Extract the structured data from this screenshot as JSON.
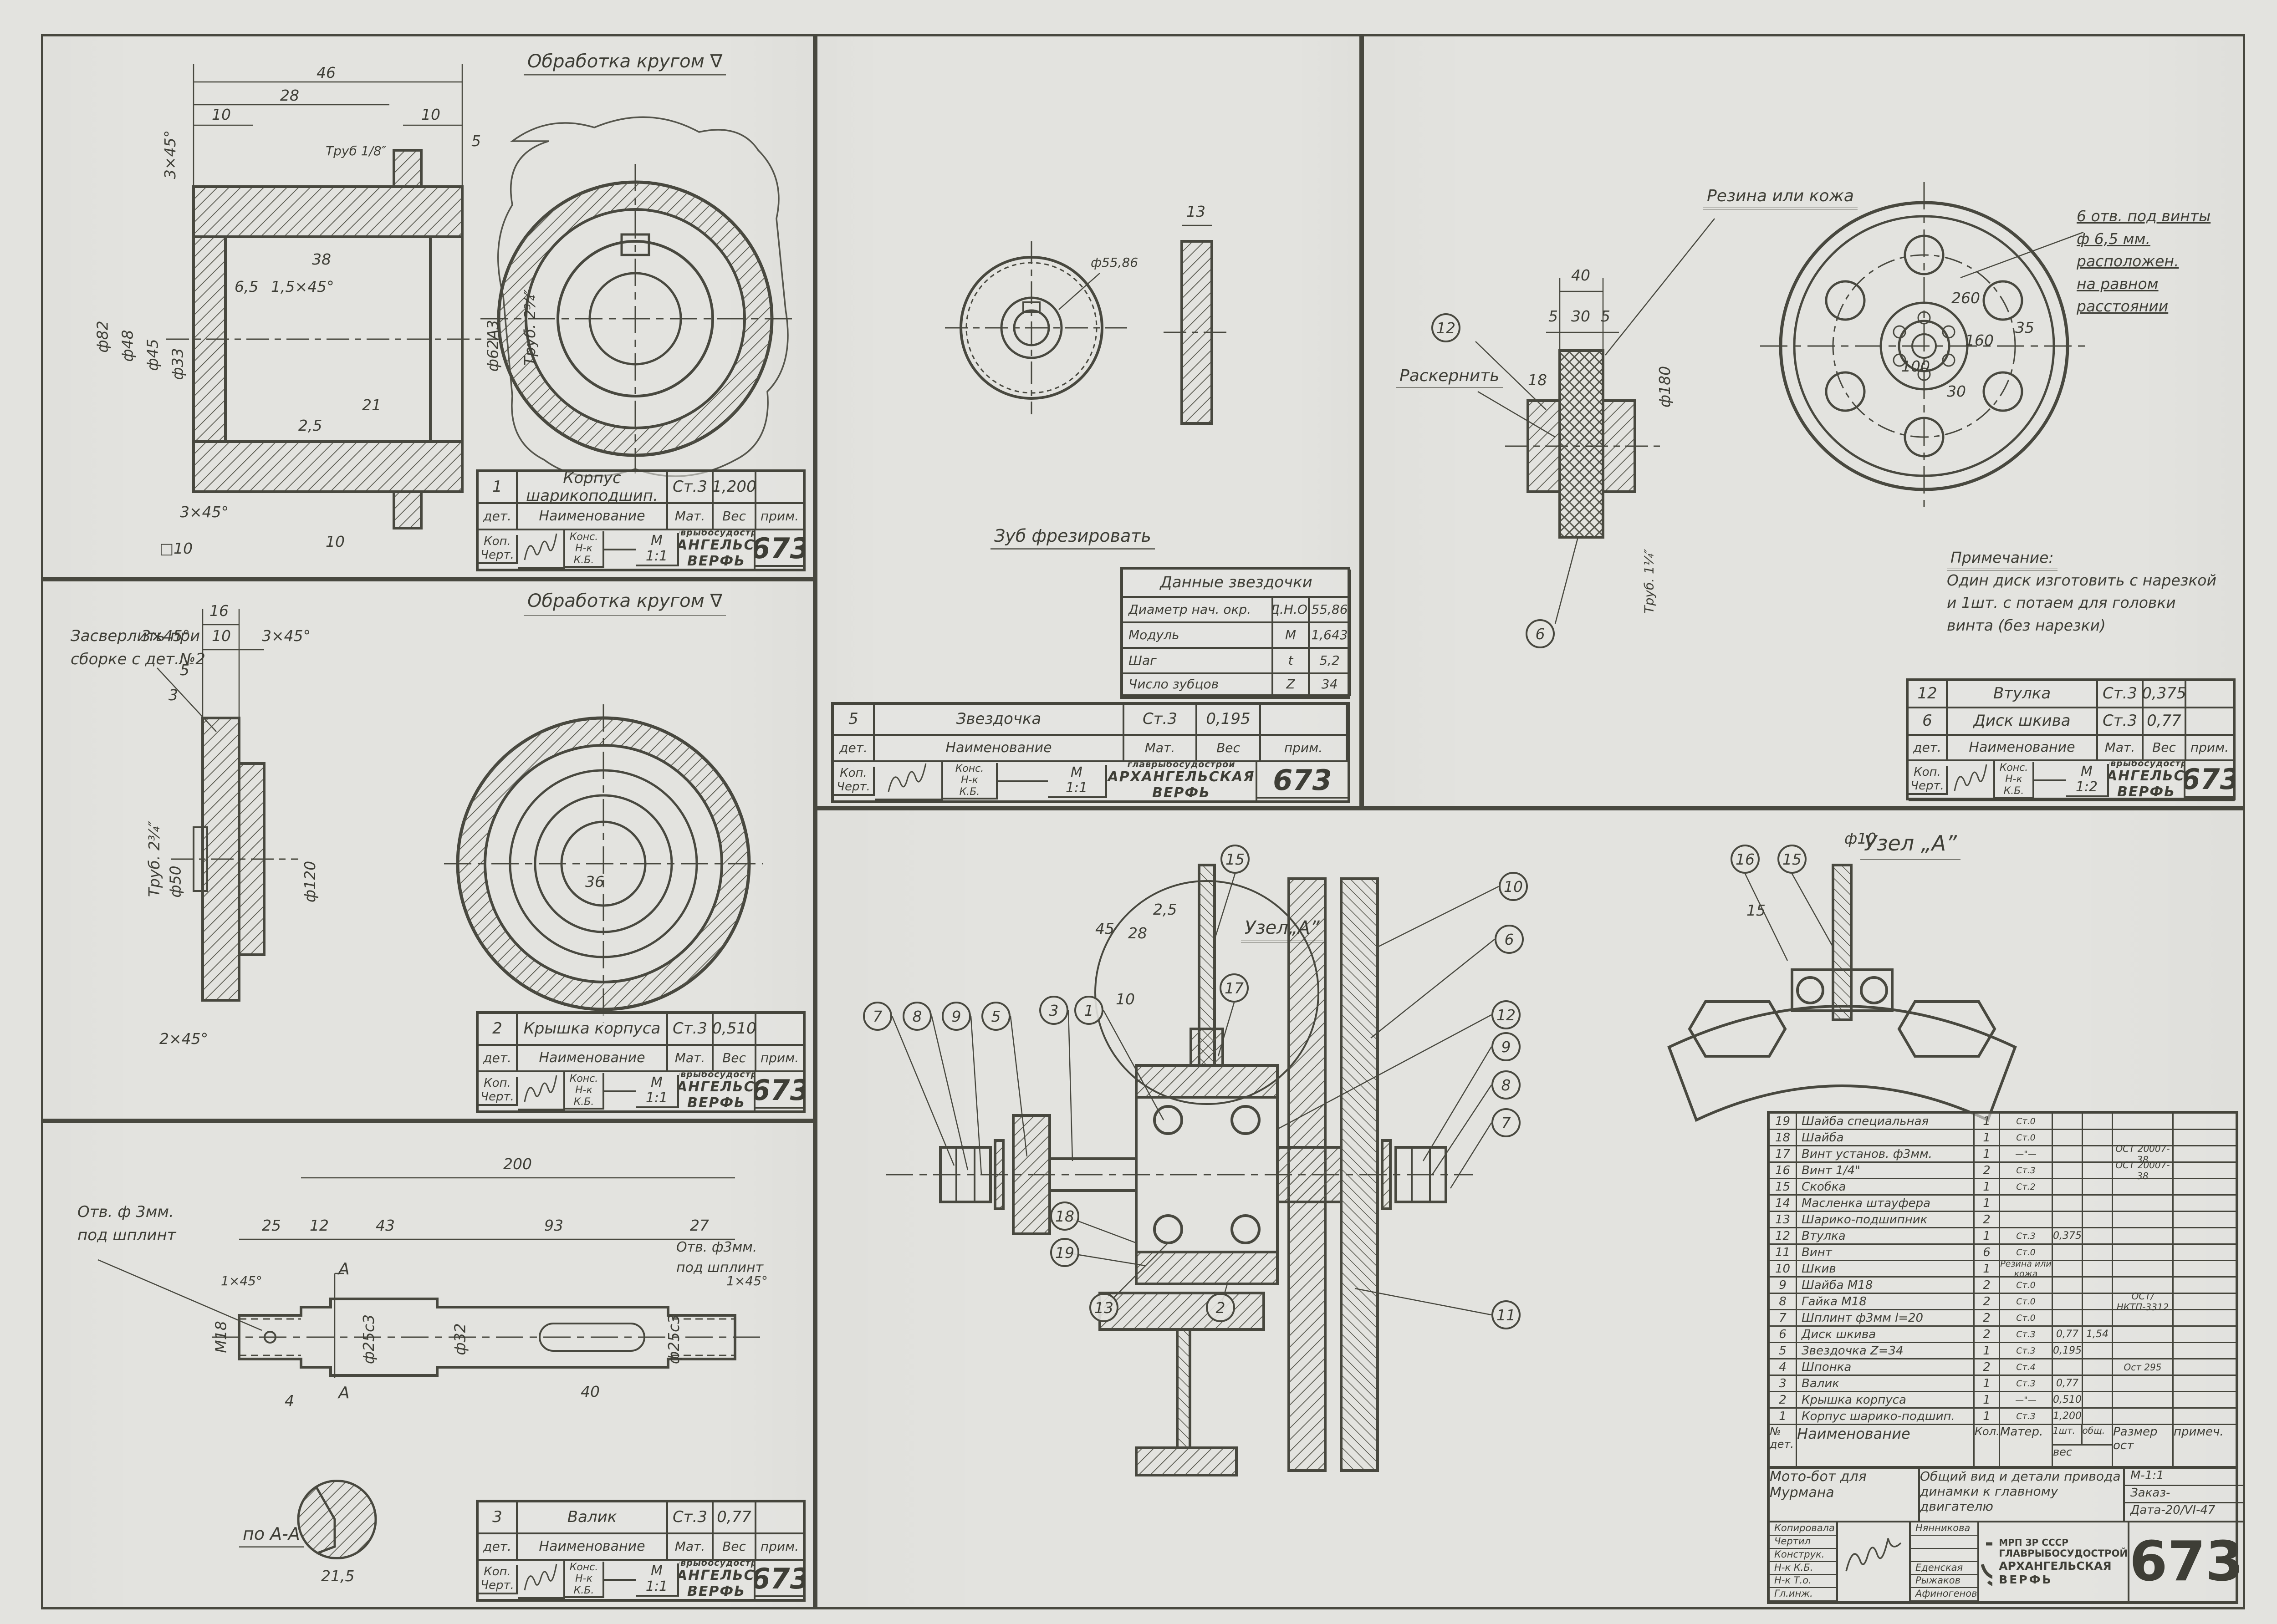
{
  "sheet": {
    "number": "673",
    "org_small": "главрыбосудострой",
    "org_name1": "АРХАНГЕЛЬСКАЯ",
    "org_name2": "ВЕРФЬ"
  },
  "tb": {
    "det": "дет.",
    "name": "Наименование",
    "mat": "Мат.",
    "ves": "Вес",
    "prim": "прим.",
    "kop": "Коп.",
    "chert": "Черт.",
    "kons": "Конс.",
    "nk_kb": "Н-к\nК.Б."
  },
  "p1": {
    "heading": "Обработка кругом ∇",
    "item": {
      "num": "1",
      "name": "Корпус шарикоподшип.",
      "mat": "Ст.3",
      "ves": "1,200"
    },
    "scale1": "М",
    "scale2": "1:1",
    "dims": [
      "46",
      "28",
      "10",
      "10",
      "5",
      "3×45°",
      "Труб 1/8″",
      "38",
      "1,5×45°",
      "6,5",
      "ф82",
      "ф48",
      "ф45",
      "ф33",
      "ф62А3",
      "Труб. 2¾″",
      "21",
      "2,5",
      "3×45°",
      "□10",
      "10"
    ]
  },
  "p2": {
    "heading": "Обработка кругом ∇",
    "note": "Засверлить при\nсборке с дет.№2",
    "item": {
      "num": "2",
      "name": "Крышка корпуса",
      "mat": "Ст.3",
      "ves": "0,510"
    },
    "scale1": "М",
    "scale2": "1:1",
    "dims": [
      "16",
      "3×45°",
      "10",
      "3×45°",
      "5",
      "3",
      "Труб. 2¾″",
      "ф50",
      "ф120",
      "2×45°",
      "36"
    ]
  },
  "p3": {
    "label_left": "Отв. ф 3мм.\nпод шплинт",
    "label_right": "Отв. ф3мм.\nпод шплинт",
    "section": "по А-А",
    "item": {
      "num": "3",
      "name": "Валик",
      "mat": "Ст.3",
      "ves": "0,77"
    },
    "scale1": "М",
    "scale2": "1:1",
    "dims": [
      "200",
      "25",
      "12",
      "43",
      "93",
      "27",
      "1×45°",
      "1×45°",
      "М18",
      "ф25с3",
      "ф32",
      "ф25с3",
      "4",
      "40",
      "21,5",
      "А",
      "А"
    ]
  },
  "p4": {
    "label": "Зуб фрезировать",
    "dims": [
      "13",
      "ф55,86"
    ],
    "table": {
      "title": "Данные звездочки",
      "rows": [
        {
          "l": "Диаметр нач. окр.",
          "s": "Д.Н.О.",
          "v": "55,86"
        },
        {
          "l": "Модуль",
          "s": "М",
          "v": "1,643"
        },
        {
          "l": "Шаг",
          "s": "t",
          "v": "5,2"
        },
        {
          "l": "Число зубцов",
          "s": "Z",
          "v": "34"
        }
      ]
    },
    "item": {
      "num": "5",
      "name": "Звездочка",
      "mat": "Ст.3",
      "ves": "0,195"
    },
    "scale1": "М",
    "scale2": "1:1"
  },
  "p5": {
    "label_rubber": "Резина или кожа",
    "label_kern": "Раскернить",
    "holes_note": "6 отв. под винты\nф 6,5 мм. расположен.\nна равном расстоянии",
    "note_title": "Примечание:",
    "note_body": "Один диск изготовить с нарезкой\nи 1шт. с потаем для головки\nвинта (без нарезки)",
    "items": [
      {
        "num": "12",
        "name": "Втулка",
        "mat": "Ст.3",
        "ves": "0,375"
      },
      {
        "num": "6",
        "name": "Диск шкива",
        "mat": "Ст.3",
        "ves": "0,77"
      }
    ],
    "scale1": "М",
    "scale2": "1:2",
    "callouts": [
      "12",
      "6"
    ],
    "dims": [
      "40",
      "5",
      "30",
      "5",
      "18",
      "ф180",
      "Труб. 1¼″",
      "260",
      "160",
      "100",
      "35",
      "30"
    ]
  },
  "asm": {
    "heading": "Узел „А”",
    "marker": "Узел„А”",
    "callouts": [
      "7",
      "8",
      "9",
      "5",
      "3",
      "1",
      "15",
      "17",
      "10",
      "6",
      "12",
      "9",
      "8",
      "7",
      "11",
      "18",
      "19",
      "13",
      "2",
      "16",
      "15"
    ],
    "dims": [
      "45",
      "2,5",
      "28",
      "10",
      "ф10",
      "15"
    ]
  },
  "pl": {
    "header": {
      "n": "№\nдет.",
      "name": "Наименование",
      "qty": "Кол.",
      "mat": "Матер.",
      "ves": "вес",
      "w1": "1шт.",
      "w2": "общ.",
      "size": "Размер\nост",
      "note": "примеч."
    },
    "rows": [
      {
        "n": "19",
        "name": "Шайба специальная",
        "qty": "1",
        "mat": "Ст.0",
        "w1": "",
        "w2": "",
        "std": "",
        "note": ""
      },
      {
        "n": "18",
        "name": "Шайба",
        "qty": "1",
        "mat": "Ст.0",
        "w1": "",
        "w2": "",
        "std": "",
        "note": ""
      },
      {
        "n": "17",
        "name": "Винт установ. ф3мм.",
        "qty": "1",
        "mat": "—\"—",
        "w1": "",
        "w2": "",
        "std": "ОСТ 20007-38",
        "note": ""
      },
      {
        "n": "16",
        "name": "Винт 1/4\"",
        "qty": "2",
        "mat": "Ст.3",
        "w1": "",
        "w2": "",
        "std": "ОСТ 20007-38",
        "note": ""
      },
      {
        "n": "15",
        "name": "Скобка",
        "qty": "1",
        "mat": "Ст.2",
        "w1": "",
        "w2": "",
        "std": "",
        "note": ""
      },
      {
        "n": "14",
        "name": "Масленка штауфера",
        "qty": "1",
        "mat": "",
        "w1": "",
        "w2": "",
        "std": "",
        "note": ""
      },
      {
        "n": "13",
        "name": "Шарико-подшипник",
        "qty": "2",
        "mat": "",
        "w1": "",
        "w2": "",
        "std": "",
        "note": ""
      },
      {
        "n": "12",
        "name": "Втулка",
        "qty": "1",
        "mat": "Ст.3",
        "w1": "0,375",
        "w2": "",
        "std": "",
        "note": ""
      },
      {
        "n": "11",
        "name": "Винт",
        "qty": "6",
        "mat": "Ст.0",
        "w1": "",
        "w2": "",
        "std": "",
        "note": ""
      },
      {
        "n": "10",
        "name": "Шкив",
        "qty": "1",
        "mat": "Резина или кожа",
        "w1": "",
        "w2": "",
        "std": "",
        "note": ""
      },
      {
        "n": "9",
        "name": "Шайба М18",
        "qty": "2",
        "mat": "Ст.0",
        "w1": "",
        "w2": "",
        "std": "",
        "note": ""
      },
      {
        "n": "8",
        "name": "Гайка М18",
        "qty": "2",
        "mat": "Ст.0",
        "w1": "",
        "w2": "",
        "std": "ОСТ/НКТП-3312",
        "note": ""
      },
      {
        "n": "7",
        "name": "Шплинт ф3мм l=20",
        "qty": "2",
        "mat": "Ст.0",
        "w1": "",
        "w2": "",
        "std": "",
        "note": ""
      },
      {
        "n": "6",
        "name": "Диск шкива",
        "qty": "2",
        "mat": "Ст.3",
        "w1": "0,77",
        "w2": "1,54",
        "std": "",
        "note": ""
      },
      {
        "n": "5",
        "name": "Звездочка Z=34",
        "qty": "1",
        "mat": "Ст.3",
        "w1": "0,195",
        "w2": "",
        "std": "",
        "note": ""
      },
      {
        "n": "4",
        "name": "Шпонка",
        "qty": "2",
        "mat": "Ст.4",
        "w1": "",
        "w2": "",
        "std": "Ост 295",
        "note": ""
      },
      {
        "n": "3",
        "name": "Валик",
        "qty": "1",
        "mat": "Ст.3",
        "w1": "0,77",
        "w2": "",
        "std": "",
        "note": ""
      },
      {
        "n": "2",
        "name": "Крышка корпуса",
        "qty": "1",
        "mat": "—\"—",
        "w1": "0,510",
        "w2": "",
        "std": "",
        "note": ""
      },
      {
        "n": "1",
        "name": "Корпус шарико-подшип.",
        "qty": "1",
        "mat": "Ст.3",
        "w1": "1,200",
        "w2": "",
        "std": "",
        "note": ""
      }
    ]
  },
  "mtb": {
    "object": "Мото-бот для\nМурмана",
    "title": "Общий вид и детали\nпривода динамки к главному\nдвигателю",
    "scale": "М-1:1",
    "order": "Заказ-",
    "date": "Дата-20/VI-47",
    "roles": [
      "Копировала",
      "Чертил",
      "Конструк.",
      "Н-к К.Б.",
      "Н-к Т.о.",
      "Гл.инж."
    ],
    "names": [
      "Нянникова",
      "",
      "",
      "Еденская",
      "Рыжаков",
      "Афиногенов"
    ],
    "org1": "МРП ЗР СССР",
    "org2": "ГЛАВРЫБОСУДОСТРОЙ",
    "org3": "АРХАНГЕЛЬСКАЯ",
    "org4": "ВЕРФЬ",
    "number": "673"
  }
}
